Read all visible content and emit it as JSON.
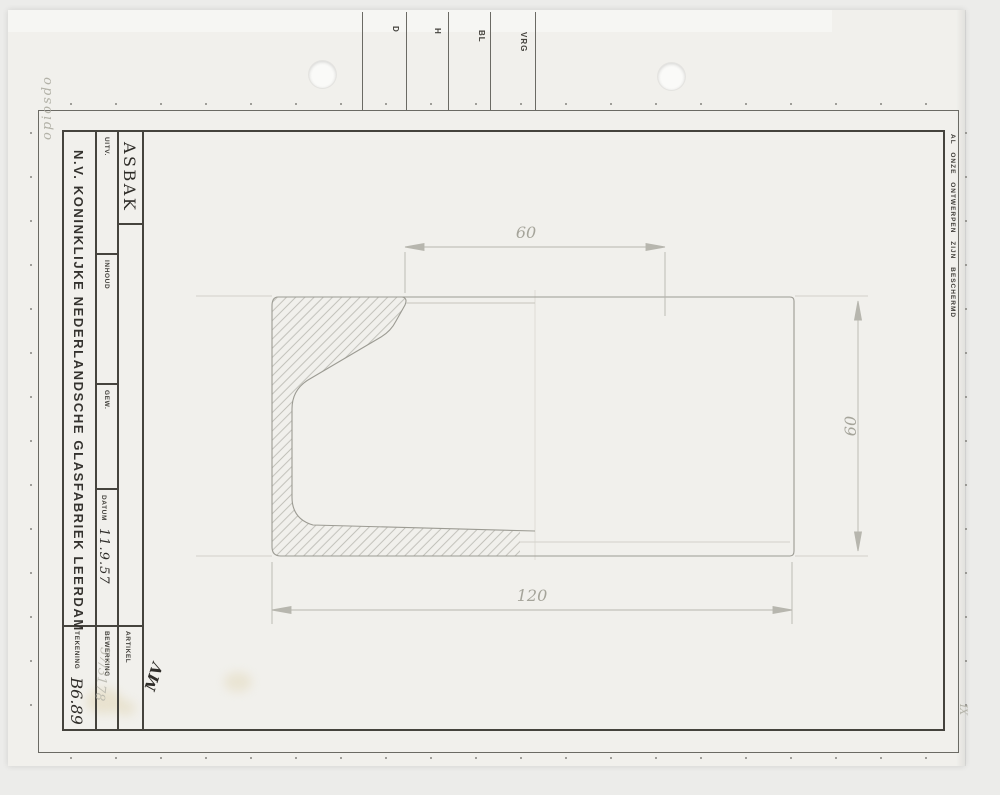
{
  "top_strip": {
    "columns": [
      "D",
      "H",
      "BL",
      "VRG"
    ]
  },
  "margin_notes": {
    "left_pencil": "opiosdo",
    "bottom_right_pencil": "IX"
  },
  "rights_notice": "AL ONZE ONTWERPEN ZIJN BESCHERMD",
  "title_block": {
    "company": "N.V. KONINKLIJKE NEDERLANDSCHE GLASFABRIEK LEERDAM",
    "drawing_title": "ASBAK",
    "approval_initials": "MV",
    "fields": {
      "uitv_label": "UITV.",
      "inhoud_label": "INHOUD",
      "gew_label": "GEW.",
      "datum_label": "DATUM",
      "datum_value": "11.9.57",
      "bewerking_label": "BEWERKING",
      "artikel_label": "ARTIKEL",
      "artikel_value": "57/3178",
      "tekening_label": "TEKENING",
      "tekening_value": "B6.89"
    }
  },
  "drawing": {
    "dimensions": {
      "top_width": "60",
      "right_height": "60",
      "bottom_width": "120"
    }
  },
  "colors": {
    "paper": "#f1f0ec",
    "background": "#ececea",
    "frame_ink": "#45433d",
    "pencil": "#a5a49a",
    "handwriting_ink": "#2f2d29"
  }
}
